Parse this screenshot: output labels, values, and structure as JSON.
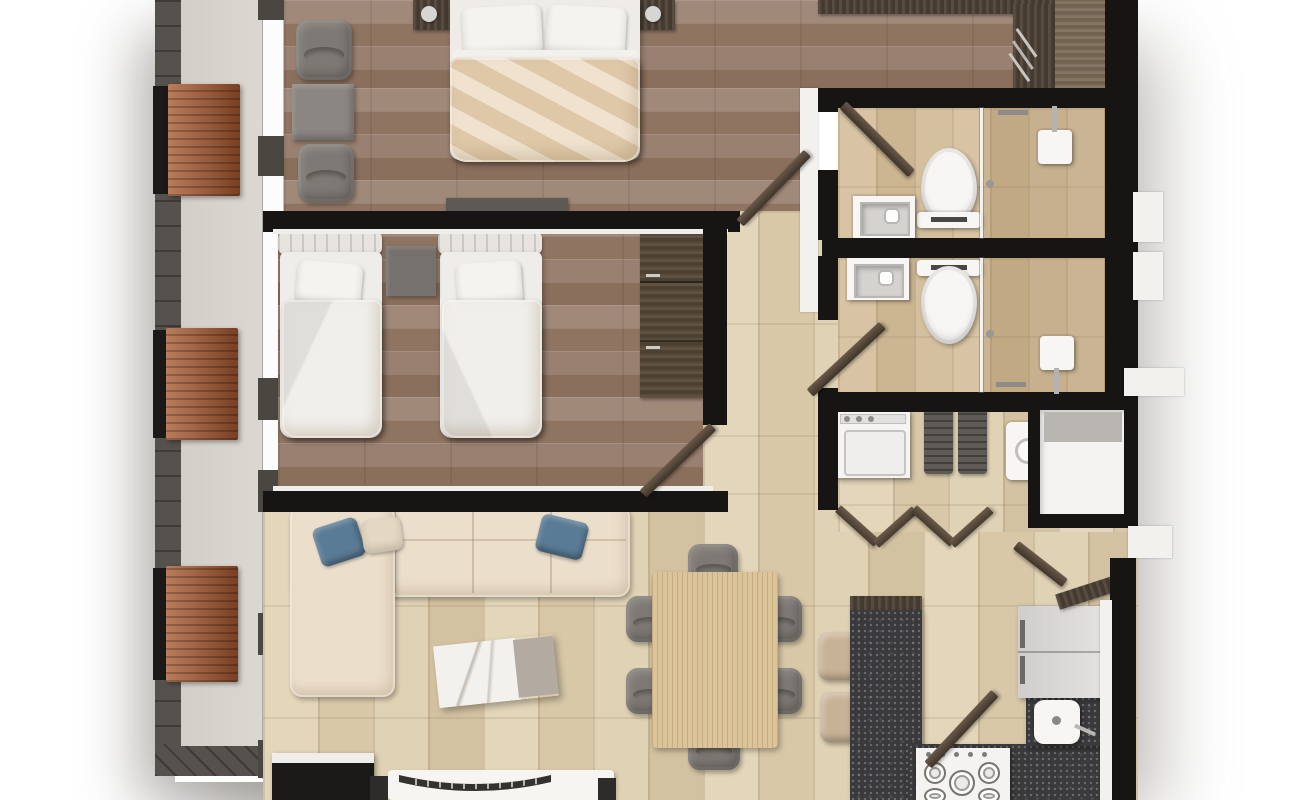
{
  "meta": {
    "kind": "3d-rendered-floor-plan",
    "view": "top-down",
    "canvas": "1300x800"
  },
  "palette": {
    "wall": "#171513",
    "wood_floor": "#987d6c",
    "travertine_tile": "#ddcdae",
    "bath_tile": "#d2bd9c",
    "balcony_floor": "#d6d2cc",
    "deck_rail": "#55514c",
    "planter_wood": "#a8572f",
    "dark_wood_furniture": "#4c4034",
    "granite_counter": "#3a393b",
    "sofa_cream": "#ebdfcc",
    "accent_blue": "#5a7b96",
    "bed_linen": "#f5f3ef",
    "master_duvet": "#e9d6b9",
    "dining_wood": "#dcc49a",
    "fixture_white": "#f6f5f2",
    "chair_gray": "#7e7974"
  },
  "rooms": [
    {
      "id": "balcony",
      "name": "Balcony terrace",
      "items": [
        "deck railing",
        "wood planter",
        "wood planter",
        "wood planter",
        "sliding glass wall"
      ]
    },
    {
      "id": "master-bedroom",
      "name": "Master bedroom",
      "items": [
        "double bed",
        "pillow",
        "pillow",
        "nightstand",
        "nightstand",
        "lounge chair",
        "lounge chair",
        "side table",
        "media console"
      ]
    },
    {
      "id": "walk-in-closet",
      "name": "Walk-in closet",
      "items": [
        "wardrobe shelving",
        "hanging rail"
      ]
    },
    {
      "id": "bathroom-ensuite",
      "name": "Ensuite bathroom",
      "items": [
        "toilet",
        "vanity sink",
        "walk-in shower",
        "glass partition",
        "shower head",
        "door"
      ]
    },
    {
      "id": "bathroom-2",
      "name": "Second bathroom",
      "items": [
        "toilet",
        "vanity sink",
        "walk-in shower",
        "glass partition",
        "shower head",
        "door"
      ]
    },
    {
      "id": "bedroom-2",
      "name": "Second bedroom",
      "items": [
        "twin bed",
        "twin bed",
        "nightstand",
        "wardrobe",
        "door"
      ]
    },
    {
      "id": "hallway",
      "name": "Hallway",
      "items": [
        "zigzag wall shelf"
      ]
    },
    {
      "id": "laundry",
      "name": "Laundry room",
      "items": [
        "washing machine",
        "laundry baskets",
        "water heater",
        "storage closet",
        "door"
      ]
    },
    {
      "id": "living-room",
      "name": "Living room",
      "items": [
        "L-shaped sofa",
        "blue cushion",
        "blue cushion",
        "cream cushion",
        "marble coffee table",
        "sideboard",
        "tv stand",
        "curved tv",
        "speaker",
        "speaker"
      ]
    },
    {
      "id": "dining-area",
      "name": "Dining area",
      "items": [
        "dining table",
        "dining chair",
        "dining chair",
        "dining chair",
        "dining chair",
        "dining chair",
        "dining chair"
      ]
    },
    {
      "id": "kitchen",
      "name": "Kitchen",
      "items": [
        "granite island",
        "bar stool",
        "bar stool",
        "gas stove",
        "kitchen sink",
        "refrigerator",
        "granite counter",
        "range hood",
        "door"
      ]
    }
  ]
}
